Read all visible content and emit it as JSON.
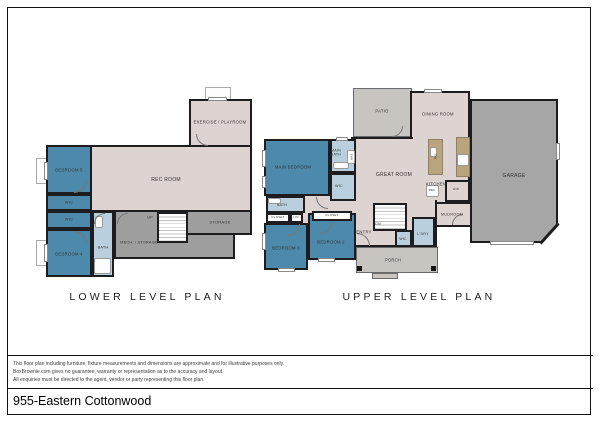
{
  "meta": {
    "width": 600,
    "height": 424
  },
  "colors": {
    "wall": "#1d1d20",
    "beige": "#ddd3d0",
    "blue": "#4c89aa",
    "bath": "#b9cfdd",
    "gray": "#9e9e9e",
    "garage": "#a6a6a6",
    "porch": "#c8c4c0",
    "tan": "#b8a57e",
    "white": "#ffffff"
  },
  "footer": {
    "title": "955-Eastern Cottonwood",
    "disclaimer_lines": [
      "This floor plan including furniture, fixture measurements and dimensions are approximate and for illustrative purposes only.",
      "BoxBrownie.com gives no guarantee, warranty or representation as to the accuracy and layout.",
      "All enquiries must be directed to the agent, vendor or party representing this floor plan."
    ]
  },
  "plans": [
    {
      "id": "lower",
      "title": "LOWER LEVEL PLAN",
      "elements": [
        {
          "type": "well",
          "name": "egress-window-well-top",
          "x": 205,
          "y": 87,
          "w": 26,
          "h": 13
        },
        {
          "type": "well",
          "name": "egress-window-well-bed5",
          "x": 36,
          "y": 158,
          "w": 11,
          "h": 26
        },
        {
          "type": "well",
          "name": "egress-window-well-bed4",
          "x": 36,
          "y": 240,
          "w": 11,
          "h": 26
        },
        {
          "type": "room",
          "name": "room-exercise-playroom",
          "x": 189,
          "y": 99,
          "w": 63,
          "h": 48,
          "fill": "beige"
        },
        {
          "type": "room",
          "name": "room-rec",
          "x": 46,
          "y": 145,
          "w": 206,
          "h": 67,
          "fill": "beige"
        },
        {
          "type": "room",
          "name": "room-mech-storage",
          "x": 114,
          "y": 210,
          "w": 121,
          "h": 49,
          "fill": "gray"
        },
        {
          "type": "room",
          "name": "room-storage",
          "x": 160,
          "y": 210,
          "w": 92,
          "h": 25,
          "fill": "gray"
        },
        {
          "type": "stairs",
          "name": "stairs-up",
          "x": 157,
          "y": 212,
          "w": 31,
          "h": 31
        },
        {
          "type": "room",
          "name": "room-bedroom5",
          "x": 46,
          "y": 145,
          "w": 46,
          "h": 49,
          "fill": "blue"
        },
        {
          "type": "room",
          "name": "room-wic-1",
          "x": 46,
          "y": 194,
          "w": 46,
          "h": 17,
          "fill": "blue"
        },
        {
          "type": "room",
          "name": "room-wic-2",
          "x": 46,
          "y": 211,
          "w": 46,
          "h": 18,
          "fill": "blue"
        },
        {
          "type": "room",
          "name": "room-bedroom4",
          "x": 46,
          "y": 229,
          "w": 46,
          "h": 48,
          "fill": "blue"
        },
        {
          "type": "room",
          "name": "room-bath-lower",
          "x": 92,
          "y": 211,
          "w": 22,
          "h": 66,
          "fill": "bath"
        },
        {
          "type": "fixture",
          "name": "bathtub",
          "x": 94,
          "y": 258,
          "w": 17,
          "h": 16
        },
        {
          "type": "fixture",
          "name": "bath-vanity-lower",
          "x": 95,
          "y": 216,
          "w": 8,
          "h": 12
        },
        {
          "type": "window",
          "name": "window-bedroom5",
          "x": 44,
          "y": 162,
          "w": 4,
          "h": 18
        },
        {
          "type": "window",
          "name": "window-bedroom4",
          "x": 44,
          "y": 244,
          "w": 4,
          "h": 18
        },
        {
          "type": "window",
          "name": "window-exercise",
          "x": 208,
          "y": 97,
          "w": 19,
          "h": 4
        },
        {
          "type": "door",
          "name": "door-bedroom5",
          "x": 74,
          "y": 180,
          "s": 13,
          "rot": 0
        },
        {
          "type": "door",
          "name": "door-bedroom4",
          "x": 74,
          "y": 231,
          "s": 13,
          "rot": 270
        },
        {
          "type": "door",
          "name": "door-bath-lower",
          "x": 94,
          "y": 213,
          "s": 11,
          "rot": 180
        },
        {
          "type": "door",
          "name": "door-mech",
          "x": 117,
          "y": 213,
          "s": 11,
          "rot": 180
        },
        {
          "type": "door",
          "name": "door-exercise",
          "x": 196,
          "y": 134,
          "s": 12,
          "rot": 90
        },
        {
          "type": "label",
          "name": "label-exercise-playroom",
          "text": "EXERCISE / PLAYROOM",
          "x": 220,
          "y": 122,
          "fs": 4.2
        },
        {
          "type": "label",
          "name": "label-rec-room",
          "text": "REC ROOM",
          "x": 166,
          "y": 180,
          "fs": 5
        },
        {
          "type": "label",
          "name": "label-bedroom5",
          "text": "BEDROOM 5",
          "x": 69,
          "y": 170,
          "fs": 4.2
        },
        {
          "type": "label",
          "name": "label-wic-1",
          "text": "WIC",
          "x": 69,
          "y": 203,
          "fs": 3.8
        },
        {
          "type": "label",
          "name": "label-wic-2",
          "text": "WIC",
          "x": 69,
          "y": 220,
          "fs": 3.8
        },
        {
          "type": "label",
          "name": "label-bedroom4",
          "text": "BEDROOM 4",
          "x": 69,
          "y": 254,
          "fs": 4.2
        },
        {
          "type": "label",
          "name": "label-bath-lower",
          "text": "BATH",
          "x": 103,
          "y": 248,
          "fs": 3.8
        },
        {
          "type": "label",
          "name": "label-mech-storage",
          "text": "MECH. / STORAGE",
          "x": 139,
          "y": 243,
          "fs": 3.8
        },
        {
          "type": "label",
          "name": "label-storage",
          "text": "STORAGE",
          "x": 220,
          "y": 222,
          "fs": 4
        },
        {
          "type": "label",
          "name": "label-up",
          "text": "UP",
          "x": 150,
          "y": 218,
          "fs": 3.8
        }
      ]
    },
    {
      "id": "upper",
      "title": "UPPER LEVEL PLAN",
      "elements": [
        {
          "type": "room",
          "name": "area-patio",
          "x": 353,
          "y": 88,
          "w": 59,
          "h": 49,
          "fill": "porch",
          "border": "thin"
        },
        {
          "type": "room",
          "name": "area-porch",
          "x": 356,
          "y": 247,
          "w": 82,
          "h": 26,
          "fill": "porch",
          "border": "thin"
        },
        {
          "type": "room",
          "name": "area-porch-step",
          "x": 372,
          "y": 273,
          "w": 26,
          "h": 6,
          "fill": "porch",
          "border": "thin"
        },
        {
          "type": "room",
          "name": "room-dining",
          "x": 410,
          "y": 91,
          "w": 60,
          "h": 48,
          "fill": "beige"
        },
        {
          "type": "room",
          "name": "room-great",
          "x": 351,
          "y": 137,
          "w": 119,
          "h": 88,
          "fill": "beige"
        },
        {
          "type": "room",
          "name": "room-entry",
          "x": 351,
          "y": 200,
          "w": 86,
          "h": 47,
          "fill": "beige"
        },
        {
          "type": "room",
          "name": "patch-dining-great",
          "x": 413,
          "y": 135,
          "w": 54,
          "h": 6,
          "fill": "beige",
          "border": "none"
        },
        {
          "type": "room",
          "name": "patch-great-entry",
          "x": 353,
          "y": 198,
          "w": 82,
          "h": 6,
          "fill": "beige",
          "border": "none"
        },
        {
          "type": "room",
          "name": "patch-hall",
          "x": 303,
          "y": 196,
          "w": 50,
          "h": 28,
          "fill": "beige",
          "border": "none"
        },
        {
          "type": "room",
          "name": "room-garage",
          "x": 470,
          "y": 99,
          "w": 88,
          "h": 144,
          "fill": "garage",
          "clip": "polygon(0 0,100% 0,100% 86%,80% 100%,0 100%)"
        },
        {
          "type": "wall",
          "name": "garage-corner-wall",
          "x": 536,
          "y": 232,
          "w": 27,
          "h": 3,
          "rot": 132
        },
        {
          "type": "room",
          "name": "room-mudroom",
          "x": 435,
          "y": 202,
          "w": 37,
          "h": 25,
          "fill": "beige"
        },
        {
          "type": "room",
          "name": "room-wip-pantry",
          "x": 445,
          "y": 180,
          "w": 25,
          "h": 22,
          "fill": "beige"
        },
        {
          "type": "counter",
          "name": "kitchen-island",
          "x": 428,
          "y": 139,
          "w": 15,
          "h": 36
        },
        {
          "type": "counter",
          "name": "kitchen-counter",
          "x": 456,
          "y": 137,
          "w": 14,
          "h": 40
        },
        {
          "type": "fixture",
          "name": "stove",
          "x": 457,
          "y": 154,
          "w": 12,
          "h": 12
        },
        {
          "type": "fixture",
          "name": "island-sink",
          "x": 430,
          "y": 147,
          "w": 7,
          "h": 10
        },
        {
          "type": "fixture",
          "name": "refrigerator",
          "x": 426,
          "y": 185,
          "w": 13,
          "h": 12
        },
        {
          "type": "stairs",
          "name": "stairs-down",
          "x": 373,
          "y": 203,
          "w": 34,
          "h": 28
        },
        {
          "type": "room",
          "name": "room-wic-entry",
          "x": 395,
          "y": 230,
          "w": 17,
          "h": 17,
          "fill": "bath"
        },
        {
          "type": "room",
          "name": "room-laundry",
          "x": 412,
          "y": 217,
          "w": 23,
          "h": 30,
          "fill": "bath"
        },
        {
          "type": "room",
          "name": "room-main-bedroom",
          "x": 264,
          "y": 139,
          "w": 66,
          "h": 57,
          "fill": "blue"
        },
        {
          "type": "room",
          "name": "room-main-bath",
          "x": 330,
          "y": 139,
          "w": 26,
          "h": 34,
          "fill": "bath"
        },
        {
          "type": "room",
          "name": "room-main-wic",
          "x": 330,
          "y": 173,
          "w": 26,
          "h": 28,
          "fill": "bath"
        },
        {
          "type": "room",
          "name": "room-hall-bath",
          "x": 266,
          "y": 196,
          "w": 39,
          "h": 17,
          "fill": "bath"
        },
        {
          "type": "room",
          "name": "room-bedroom3",
          "x": 264,
          "y": 223,
          "w": 44,
          "h": 47,
          "fill": "blue"
        },
        {
          "type": "room",
          "name": "room-bedroom2",
          "x": 308,
          "y": 213,
          "w": 48,
          "h": 47,
          "fill": "blue"
        },
        {
          "type": "room",
          "name": "closet-bedroom3",
          "x": 266,
          "y": 213,
          "w": 24,
          "h": 10,
          "fill": "white"
        },
        {
          "type": "room",
          "name": "closet-linen",
          "x": 290,
          "y": 213,
          "w": 13,
          "h": 10,
          "fill": "white"
        },
        {
          "type": "room",
          "name": "closet-bedroom2",
          "x": 312,
          "y": 211,
          "w": 40,
          "h": 10,
          "fill": "white"
        },
        {
          "type": "fixture",
          "name": "main-bath-vanity",
          "x": 333,
          "y": 162,
          "w": 16,
          "h": 7
        },
        {
          "type": "fixture",
          "name": "shower",
          "x": 347,
          "y": 150,
          "w": 8,
          "h": 14
        },
        {
          "type": "fixture",
          "name": "hall-bath-vanity",
          "x": 268,
          "y": 198,
          "w": 13,
          "h": 6
        },
        {
          "type": "window",
          "name": "window-main-bedroom-1",
          "x": 262,
          "y": 150,
          "w": 4,
          "h": 17
        },
        {
          "type": "window",
          "name": "window-main-bedroom-2",
          "x": 262,
          "y": 176,
          "w": 4,
          "h": 12
        },
        {
          "type": "window",
          "name": "window-bedroom3-left",
          "x": 262,
          "y": 233,
          "w": 4,
          "h": 17
        },
        {
          "type": "window",
          "name": "window-bedroom3-bottom",
          "x": 278,
          "y": 268,
          "w": 17,
          "h": 4
        },
        {
          "type": "window",
          "name": "window-bedroom2-bottom",
          "x": 318,
          "y": 258,
          "w": 17,
          "h": 4
        },
        {
          "type": "window",
          "name": "window-dining",
          "x": 424,
          "y": 89,
          "w": 18,
          "h": 4
        },
        {
          "type": "window",
          "name": "window-garage",
          "x": 556,
          "y": 143,
          "w": 4,
          "h": 17
        },
        {
          "type": "window",
          "name": "garage-door",
          "x": 490,
          "y": 241,
          "w": 44,
          "h": 4
        },
        {
          "type": "window",
          "name": "window-main-bath",
          "x": 336,
          "y": 137,
          "w": 12,
          "h": 4
        },
        {
          "type": "post",
          "name": "porch-post-left",
          "x": 357,
          "y": 266,
          "w": 5,
          "h": 5
        },
        {
          "type": "post",
          "name": "porch-post-right",
          "x": 431,
          "y": 266,
          "w": 5,
          "h": 5
        },
        {
          "type": "door",
          "name": "door-front",
          "x": 357,
          "y": 233,
          "s": 13,
          "rot": 270
        },
        {
          "type": "door",
          "name": "door-main-bedroom",
          "x": 316,
          "y": 197,
          "s": 12,
          "rot": 90
        },
        {
          "type": "door",
          "name": "door-bedroom3",
          "x": 288,
          "y": 224,
          "s": 12,
          "rot": 0
        },
        {
          "type": "door",
          "name": "door-bedroom2",
          "x": 320,
          "y": 222,
          "s": 12,
          "rot": 0
        },
        {
          "type": "door",
          "name": "door-mudroom-garage",
          "x": 452,
          "y": 214,
          "s": 11,
          "rot": 180
        },
        {
          "type": "door",
          "name": "door-patio",
          "x": 392,
          "y": 126,
          "s": 11,
          "rot": 0
        },
        {
          "type": "label",
          "name": "label-patio",
          "text": "PATIO",
          "x": 382,
          "y": 111,
          "fs": 4.2
        },
        {
          "type": "label",
          "name": "label-dining",
          "text": "DINING ROOM",
          "x": 438,
          "y": 114,
          "fs": 4.2
        },
        {
          "type": "label",
          "name": "label-great-room",
          "text": "GREAT ROOM",
          "x": 394,
          "y": 175,
          "fs": 5
        },
        {
          "type": "label",
          "name": "label-garage",
          "text": "GARAGE",
          "x": 514,
          "y": 176,
          "fs": 5
        },
        {
          "type": "label",
          "name": "label-kitchen",
          "text": "KITCHEN",
          "x": 436,
          "y": 184,
          "fs": 4.2
        },
        {
          "type": "label",
          "name": "label-main-bedroom",
          "text": "MAIN BEDROOM",
          "x": 293,
          "y": 167,
          "fs": 4.2
        },
        {
          "type": "label",
          "name": "label-main-bath",
          "text": "MAIN\nBATH",
          "x": 336,
          "y": 153,
          "fs": 3.6
        },
        {
          "type": "label",
          "name": "label-main-wic",
          "text": "WIC",
          "x": 339,
          "y": 186,
          "fs": 3.6
        },
        {
          "type": "label",
          "name": "label-hall-bath",
          "text": "BATH",
          "x": 282,
          "y": 205,
          "fs": 3.6
        },
        {
          "type": "label",
          "name": "label-closet-bedroom3",
          "text": "CLOSET",
          "x": 278,
          "y": 218,
          "fs": 3
        },
        {
          "type": "label",
          "name": "label-linen",
          "text": "LIN",
          "x": 296,
          "y": 218,
          "fs": 3
        },
        {
          "type": "label",
          "name": "label-closet-bedroom2",
          "text": "CLOSET",
          "x": 332,
          "y": 216,
          "fs": 3
        },
        {
          "type": "label",
          "name": "label-bedroom3",
          "text": "BEDROOM 3",
          "x": 286,
          "y": 248,
          "fs": 4.2
        },
        {
          "type": "label",
          "name": "label-bedroom2",
          "text": "BEDROOM 2",
          "x": 331,
          "y": 242,
          "fs": 4.2
        },
        {
          "type": "label",
          "name": "label-entry",
          "text": "ENTRY",
          "x": 364,
          "y": 232,
          "fs": 4.2
        },
        {
          "type": "label",
          "name": "label-dn",
          "text": "DN",
          "x": 378,
          "y": 224,
          "fs": 3.6
        },
        {
          "type": "label",
          "name": "label-wic-entry",
          "text": "WIC",
          "x": 403,
          "y": 239,
          "fs": 3.4
        },
        {
          "type": "label",
          "name": "label-laundry",
          "text": "L'DRY",
          "x": 423,
          "y": 234,
          "fs": 3.6
        },
        {
          "type": "label",
          "name": "label-mudroom",
          "text": "MUDROOM",
          "x": 452,
          "y": 215,
          "fs": 3.8
        },
        {
          "type": "label",
          "name": "label-ref",
          "text": "REF",
          "x": 432,
          "y": 191,
          "fs": 3
        },
        {
          "type": "label",
          "name": "label-wip",
          "text": "WIP",
          "x": 456,
          "y": 190,
          "fs": 3
        },
        {
          "type": "label",
          "name": "label-shr",
          "text": "SHR",
          "x": 351,
          "y": 157,
          "fs": 2.8,
          "rot": 90
        },
        {
          "type": "label",
          "name": "label-dw",
          "text": "DW",
          "x": 435,
          "y": 157,
          "fs": 2.8,
          "rot": 90
        },
        {
          "type": "label",
          "name": "label-porch",
          "text": "PORCH",
          "x": 393,
          "y": 260,
          "fs": 4.2
        }
      ]
    }
  ]
}
